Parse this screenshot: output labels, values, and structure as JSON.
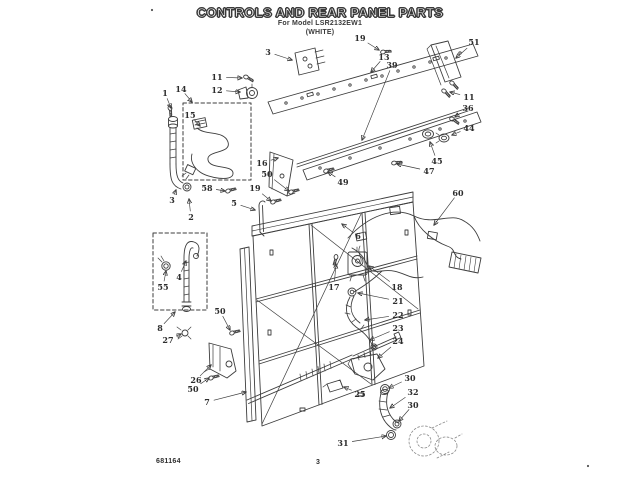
{
  "header": {
    "title": "CONTROLS AND REAR PANEL PARTS",
    "model_line": "For Model LSR2132EW1",
    "finish_line": "(WHITE)"
  },
  "footer": {
    "doc_number": "681164",
    "page_number": "3"
  },
  "diagram": {
    "type": "exploded-parts-diagram",
    "subject": "Washer controls and rear panel exploded view",
    "ink_color": "#3d3d3d",
    "callouts": [
      {
        "n": "1",
        "x": 165,
        "y": 93,
        "tx": 171,
        "ty": 108
      },
      {
        "n": "14",
        "x": 181,
        "y": 89,
        "tx": 192,
        "ty": 102
      },
      {
        "n": "15",
        "x": 190,
        "y": 115,
        "tx": 200,
        "ty": 126
      },
      {
        "n": "11",
        "x": 217,
        "y": 77,
        "tx": 242,
        "ty": 78
      },
      {
        "n": "12",
        "x": 217,
        "y": 90,
        "tx": 240,
        "ty": 92
      },
      {
        "n": "3",
        "x": 268,
        "y": 52,
        "tx": 292,
        "ty": 60
      },
      {
        "n": "19",
        "x": 360,
        "y": 38,
        "tx": 379,
        "ty": 50
      },
      {
        "n": "13",
        "x": 384,
        "y": 57,
        "tx": 371,
        "ty": 72
      },
      {
        "n": "39",
        "x": 392,
        "y": 65,
        "tx": 362,
        "ty": 140
      },
      {
        "n": "51",
        "x": 474,
        "y": 42,
        "tx": 456,
        "ty": 58
      },
      {
        "n": "11",
        "x": 469,
        "y": 97,
        "tx": 450,
        "ty": 92
      },
      {
        "n": "36",
        "x": 468,
        "y": 108,
        "tx": 455,
        "ty": 117
      },
      {
        "n": "44",
        "x": 469,
        "y": 128,
        "tx": 452,
        "ty": 135
      },
      {
        "n": "45",
        "x": 437,
        "y": 161,
        "tx": 430,
        "ty": 142
      },
      {
        "n": "47",
        "x": 429,
        "y": 171,
        "tx": 397,
        "ty": 164
      },
      {
        "n": "3",
        "x": 172,
        "y": 200,
        "tx": 176,
        "ty": 190
      },
      {
        "n": "2",
        "x": 191,
        "y": 217,
        "tx": 189,
        "ty": 199
      },
      {
        "n": "58",
        "x": 207,
        "y": 188,
        "tx": 225,
        "ty": 191
      },
      {
        "n": "19",
        "x": 255,
        "y": 188,
        "tx": 271,
        "ty": 201
      },
      {
        "n": "5",
        "x": 234,
        "y": 203,
        "tx": 255,
        "ty": 210
      },
      {
        "n": "16",
        "x": 262,
        "y": 163,
        "tx": 278,
        "ty": 158
      },
      {
        "n": "50",
        "x": 267,
        "y": 174,
        "tx": 289,
        "ty": 191
      },
      {
        "n": "49",
        "x": 343,
        "y": 182,
        "tx": 328,
        "ty": 172
      },
      {
        "n": "60",
        "x": 458,
        "y": 193,
        "tx": 434,
        "ty": 225
      },
      {
        "n": "6",
        "x": 358,
        "y": 236,
        "tx": 342,
        "ty": 224
      },
      {
        "n": "17",
        "x": 334,
        "y": 287,
        "tx": 336,
        "ty": 264
      },
      {
        "n": "18",
        "x": 397,
        "y": 287,
        "tx": 369,
        "ty": 266
      },
      {
        "n": "21",
        "x": 398,
        "y": 301,
        "tx": 358,
        "ty": 293
      },
      {
        "n": "22",
        "x": 398,
        "y": 315,
        "tx": 365,
        "ty": 320
      },
      {
        "n": "23",
        "x": 398,
        "y": 328,
        "tx": 370,
        "ty": 340
      },
      {
        "n": "24",
        "x": 398,
        "y": 341,
        "tx": 378,
        "ty": 358
      },
      {
        "n": "4",
        "x": 179,
        "y": 277,
        "tx": 186,
        "ty": 261
      },
      {
        "n": "55",
        "x": 163,
        "y": 287,
        "tx": 166,
        "ty": 271
      },
      {
        "n": "8",
        "x": 160,
        "y": 328,
        "tx": 175,
        "ty": 312
      },
      {
        "n": "27",
        "x": 168,
        "y": 340,
        "tx": 181,
        "ty": 334
      },
      {
        "n": "26",
        "x": 196,
        "y": 380,
        "tx": 211,
        "ty": 365
      },
      {
        "n": "50",
        "x": 193,
        "y": 389,
        "tx": 209,
        "ty": 378
      },
      {
        "n": "50",
        "x": 220,
        "y": 311,
        "tx": 230,
        "ty": 330
      },
      {
        "n": "7",
        "x": 207,
        "y": 402,
        "tx": 246,
        "ty": 392
      },
      {
        "n": "25",
        "x": 360,
        "y": 394,
        "tx": 344,
        "ty": 387
      },
      {
        "n": "30",
        "x": 410,
        "y": 378,
        "tx": 389,
        "ty": 388
      },
      {
        "n": "32",
        "x": 413,
        "y": 392,
        "tx": 390,
        "ty": 408
      },
      {
        "n": "30",
        "x": 413,
        "y": 405,
        "tx": 399,
        "ty": 421
      },
      {
        "n": "31",
        "x": 343,
        "y": 443,
        "tx": 386,
        "ty": 436
      }
    ],
    "artifact_dots": [
      {
        "x": 152,
        "y": 10
      },
      {
        "x": 588,
        "y": 466
      }
    ]
  }
}
